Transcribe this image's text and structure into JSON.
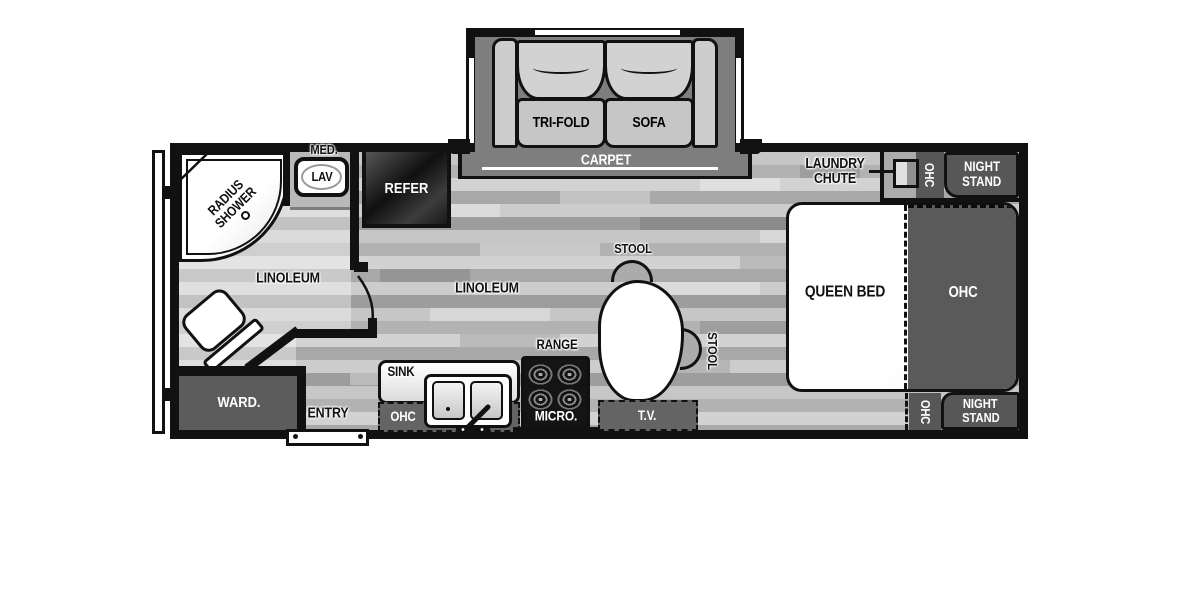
{
  "colors": {
    "wall": "#111111",
    "cabinet_dark": "#5a5a5a",
    "appliance_dark": "#141414",
    "carpet_gray": "#7e7e7e",
    "floor_gray": "#bdbdbd",
    "white": "#ffffff"
  },
  "floorplan": {
    "slideout": {
      "sofa_left": "TRI-FOLD",
      "sofa_right": "SOFA",
      "carpet": "CARPET"
    },
    "bath": {
      "shower1": "RADIUS",
      "shower2": "SHOWER",
      "med": "MED.",
      "lav": "LAV",
      "floor": "LINOLEUM"
    },
    "kitchen": {
      "refer": "REFER",
      "floor": "LINOLEUM",
      "sink": "SINK",
      "ohc": "OHC",
      "range": "RANGE",
      "micro": "MICRO.",
      "tv": "T.V."
    },
    "dinette": {
      "stool_top": "STOOL",
      "stool_right": "STOOL"
    },
    "bedroom": {
      "laundry1": "LAUNDRY",
      "laundry2": "CHUTE",
      "ohc_top": "OHC",
      "ns_top1": "NIGHT",
      "ns_top2": "STAND",
      "bed": "QUEEN BED",
      "ohc": "OHC",
      "ohc_bottom": "OHC",
      "ns_bot1": "NIGHT",
      "ns_bot2": "STAND"
    },
    "entry": {
      "ward": "WARD.",
      "entry": "ENTRY"
    }
  }
}
